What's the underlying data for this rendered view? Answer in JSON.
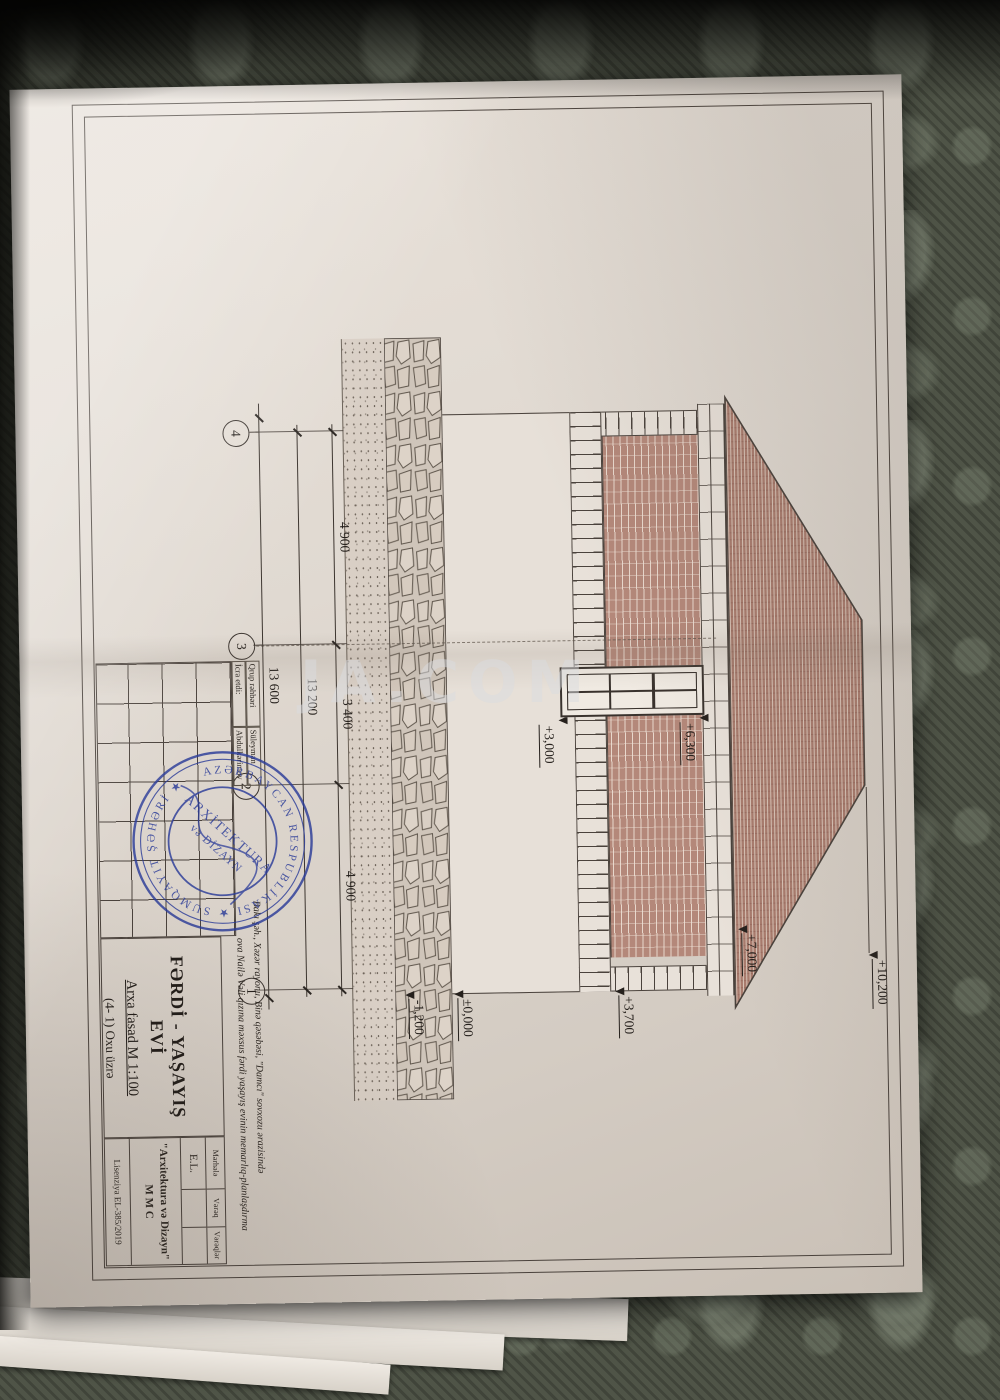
{
  "photo": {
    "watermark": "JA.COM"
  },
  "drawing": {
    "axes": {
      "a4": "4",
      "a3": "3",
      "a2": "2",
      "a1": "1"
    },
    "dimensions": {
      "seg1": "4 900",
      "seg2": "3 400",
      "seg3": "4 900",
      "total1": "13 200",
      "total2": "13 600"
    },
    "elevations": {
      "ridge": "+10,200",
      "eaves": "+7,000",
      "belt": "+3,700",
      "zero": "±0,000",
      "base": "-1,200",
      "win_head": "+6,300",
      "win_sill": "+3,000"
    },
    "title_block": {
      "role1_label": "Qrup rəhbəri",
      "role1_name": "Süleyman",
      "role2_label": "İcra etdi:",
      "role2_name": "Abdulkərimov",
      "project_line1": "Bakı şəh., Xəzər rayonu, Binə qəsəbəsi, \"Damcı\" sovxozu ərazisində",
      "project_line2": "ova Nailə Vəli qızına məxsus fərdi yaşayış evinin memarlıq-planlaşdırma",
      "object_title": "FƏRDİ - YAŞAYIŞ EVİ",
      "view_title": "Arxa fasad M 1:100",
      "view_subtitle": "(4- 1) Oxu üzrə",
      "col_stage": "Mərhələ",
      "col_sheet": "Vərəq",
      "col_sheets": "Vərəqlər",
      "stage_value": "E.L.",
      "company_name": "\"Arxitektura və Dizayn\"",
      "company_type": "M M C",
      "license": "Lisenziya EL-385/2019"
    },
    "stamp": {
      "ring_text": "AZƏRBAYCAN RESPUBLİKASI ★ SUMQAYIT ŞƏHƏRİ ★",
      "inner1": "ARXİTEKTURA",
      "inner2": "və DİZAYN"
    }
  }
}
